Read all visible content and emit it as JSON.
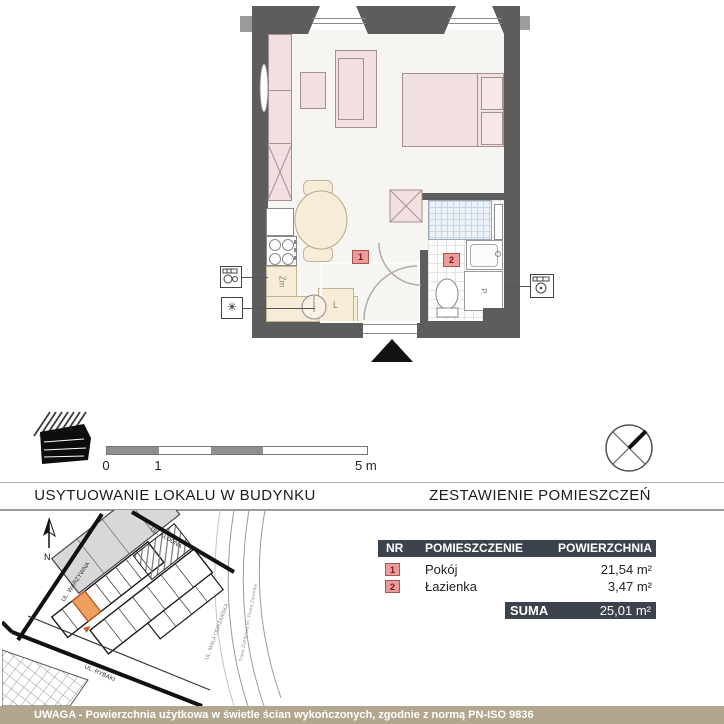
{
  "floor_plan": {
    "room1_label": "1",
    "room2_label": "2",
    "dishwasher_label": "Zm",
    "fridge_label": "L",
    "washer_label": "P."
  },
  "legend": {
    "scale_ticks": [
      "0",
      "1",
      "5 m"
    ]
  },
  "sections": {
    "left_title": "USYTUOWANIE LOKALU W BUDYNKU",
    "right_title": "ZESTAWIENIE POMIESZCZEŃ"
  },
  "site_plan": {
    "north_label": "N",
    "streets": {
      "klodna": "UL. KŁODNA",
      "warzywna": "UL. WARZYWNA",
      "rybaki": "UL. RYBAKI",
      "mala_odrzanska": "UL. MAŁA ODRZAŃSKA",
      "trasa": "Trasa Zamkowa im. Piotra Zaremby"
    }
  },
  "rooms_table": {
    "headers": {
      "nr": "NR",
      "name": "POMIESZCZENIE",
      "area": "POWIERZCHNIA"
    },
    "rows": [
      {
        "nr": "1",
        "name": "Pokój",
        "area": "21,54 m²"
      },
      {
        "nr": "2",
        "name": "Łazienka",
        "area": "3,47 m²"
      }
    ],
    "suma_label": "SUMA",
    "suma_value": "25,01 m²"
  },
  "footer": {
    "note": "UWAGA - Powierzchnia użytkowa w świetle ścian wykończonych, zgodnie z normą PN-ISO 9836"
  },
  "colors": {
    "wall": "#5d5d5d",
    "furniture_pink": "#f2e0e0",
    "kitchen_cream": "#f7ecd8",
    "badge_red": "#e89c9c",
    "table_dark": "#3d434d",
    "footer_tan": "#b2a78e",
    "highlight_orange": "#efa05e"
  }
}
